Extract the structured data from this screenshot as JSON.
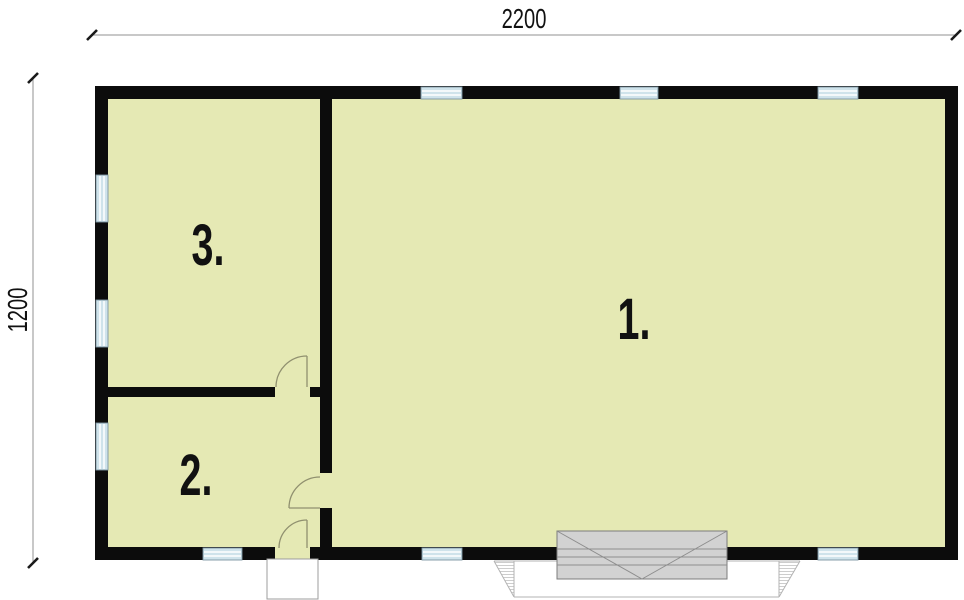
{
  "plan": {
    "dimension_top": "2200",
    "dimension_left": "1200",
    "rooms": {
      "room1": "1.",
      "room2": "2.",
      "room3": "3."
    },
    "colors": {
      "floor": "#e5e9b4",
      "wall": "#0c0c0c",
      "window": "#cfe3eb",
      "garage_door": "#d2d2d2",
      "door_line": "#90906f"
    },
    "symbols": {
      "windows": 9,
      "door_swings": 3,
      "garage_doors": 1,
      "entrance_steps": 1,
      "driveway_aprons": 1
    }
  }
}
